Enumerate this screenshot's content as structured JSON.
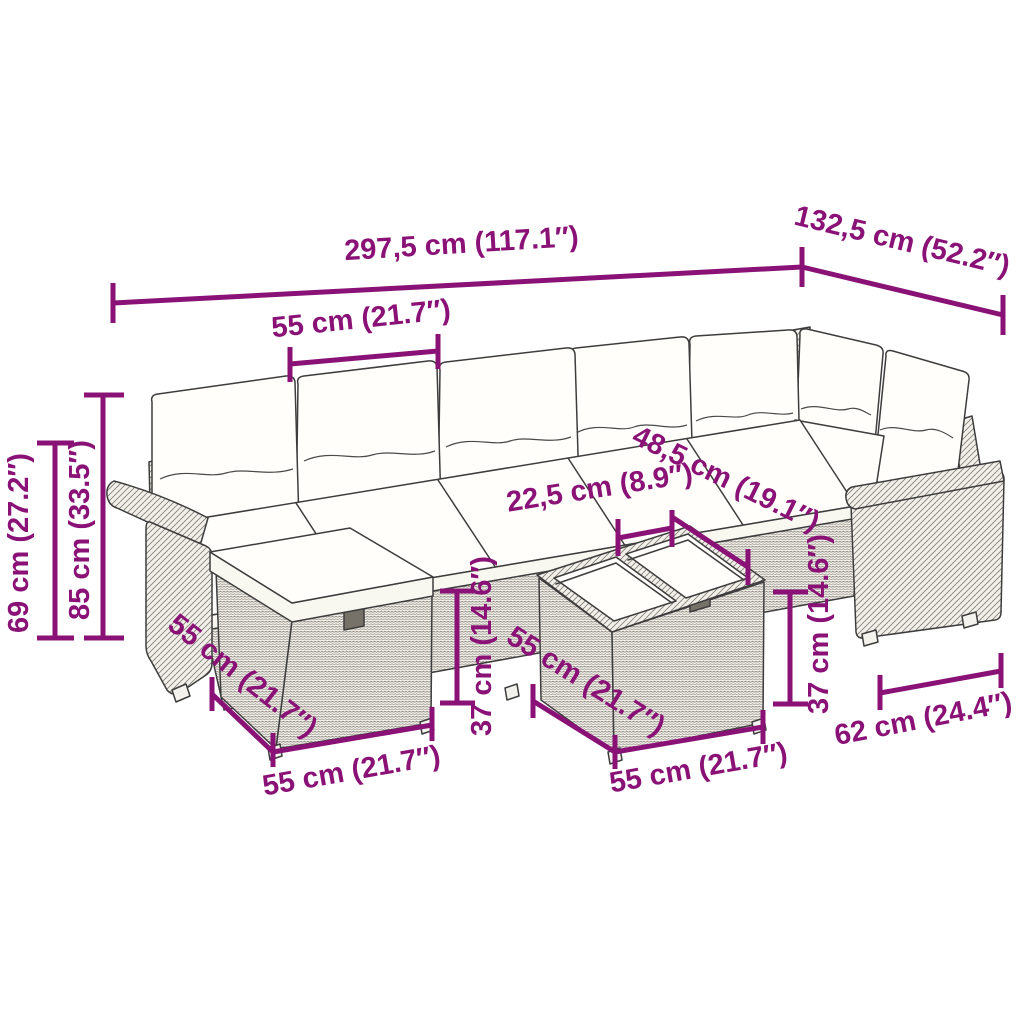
{
  "diagram": {
    "type": "furniture-dimension-diagram",
    "subject": "rattan garden lounge set with cushions, footstool and table"
  },
  "dimensions": {
    "total_length": "297,5 cm (117.1″)",
    "return_length": "132,5 cm (52.2″)",
    "seat_width": "55 cm (21.7″)",
    "back_height": "85 cm (33.5″)",
    "arm_height": "69 cm (27.2″)",
    "table_clearance": "22,5 cm (8.9″)",
    "seat_depth": "48,5 cm (19.1″)",
    "table_height": "37 cm (14.6″)",
    "stool_depth": "55 cm (21.7″)",
    "stool_width": "55 cm (21.7″)",
    "table_depth": "55 cm (21.7″)",
    "table_width": "55 cm (21.7″)",
    "stool_height": "37 cm (14.6″)",
    "armrest_width": "62 cm (24.4″)"
  },
  "style": {
    "dimension_color": "#8A1276",
    "line_color": "#3D3D3D"
  }
}
